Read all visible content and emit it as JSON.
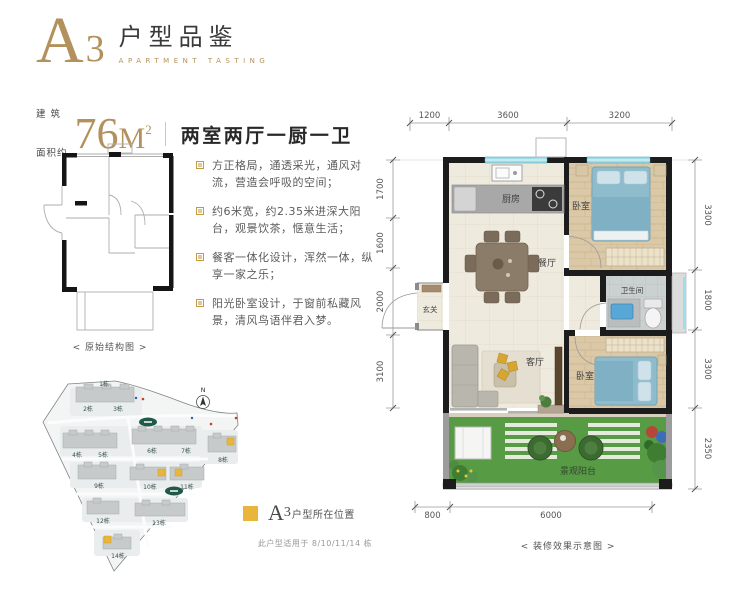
{
  "header": {
    "series_letter": "A",
    "series_number": "3",
    "title": "户型品鉴",
    "subtitle": "APARTMENT TASTING"
  },
  "area": {
    "label_top": "建 筑",
    "label_bottom": "面积约",
    "value": "76",
    "unit": "M",
    "unit_sup": "2",
    "layout_text": "两室两厅一厨一卫"
  },
  "original_plan": {
    "caption": "< 原始结构图 >"
  },
  "features": {
    "items": [
      {
        "text": "方正格局，通透采光，通风对流，营造会呼吸的空间；"
      },
      {
        "text": "约6米宽，约2.35米进深大阳台，观景饮茶，惬意生活；"
      },
      {
        "text": "餐客一体化设计，浑然一体，纵享一家之乐；"
      },
      {
        "text": "阳光卧室设计，于窗前私藏风景，清风鸟语伴君入梦。"
      }
    ]
  },
  "siteplan": {
    "compass_label": "N",
    "buildings": [
      "1栋",
      "2栋",
      "3栋",
      "4栋",
      "5栋",
      "6栋",
      "7栋",
      "8栋",
      "9栋",
      "10栋",
      "11栋",
      "12栋",
      "13栋",
      "14栋"
    ],
    "legend": {
      "series_letter": "A",
      "series_number": "3",
      "text": "户型所在位置"
    },
    "note": "此户型适用于 8/10/11/14 栋"
  },
  "floorplan": {
    "caption": "< 装修效果示意图 >",
    "rooms": {
      "kitchen": "厨房",
      "bedroom1": "卧室",
      "dining": "餐厅",
      "entry": "玄关",
      "bathroom": "卫生间",
      "living": "客厅",
      "bedroom2": "卧室",
      "balcony": "景观阳台"
    },
    "dims": {
      "top": [
        "1200",
        "3600",
        "3200"
      ],
      "left": [
        "1700",
        "1600",
        "2000",
        "3100"
      ],
      "right": [
        "3300",
        "1800",
        "3300",
        "2350"
      ],
      "bottom": [
        "800",
        "6000"
      ]
    }
  },
  "colors": {
    "gold": "#b3915c",
    "legend_gold": "#e9b63c",
    "wall_black": "#1c1c1c",
    "window_cyan": "#9edee8",
    "grass_green": "#579c45",
    "bed_blue": "#8fbccd",
    "text_dark": "#3a3a3a",
    "text_gray": "#666666"
  }
}
